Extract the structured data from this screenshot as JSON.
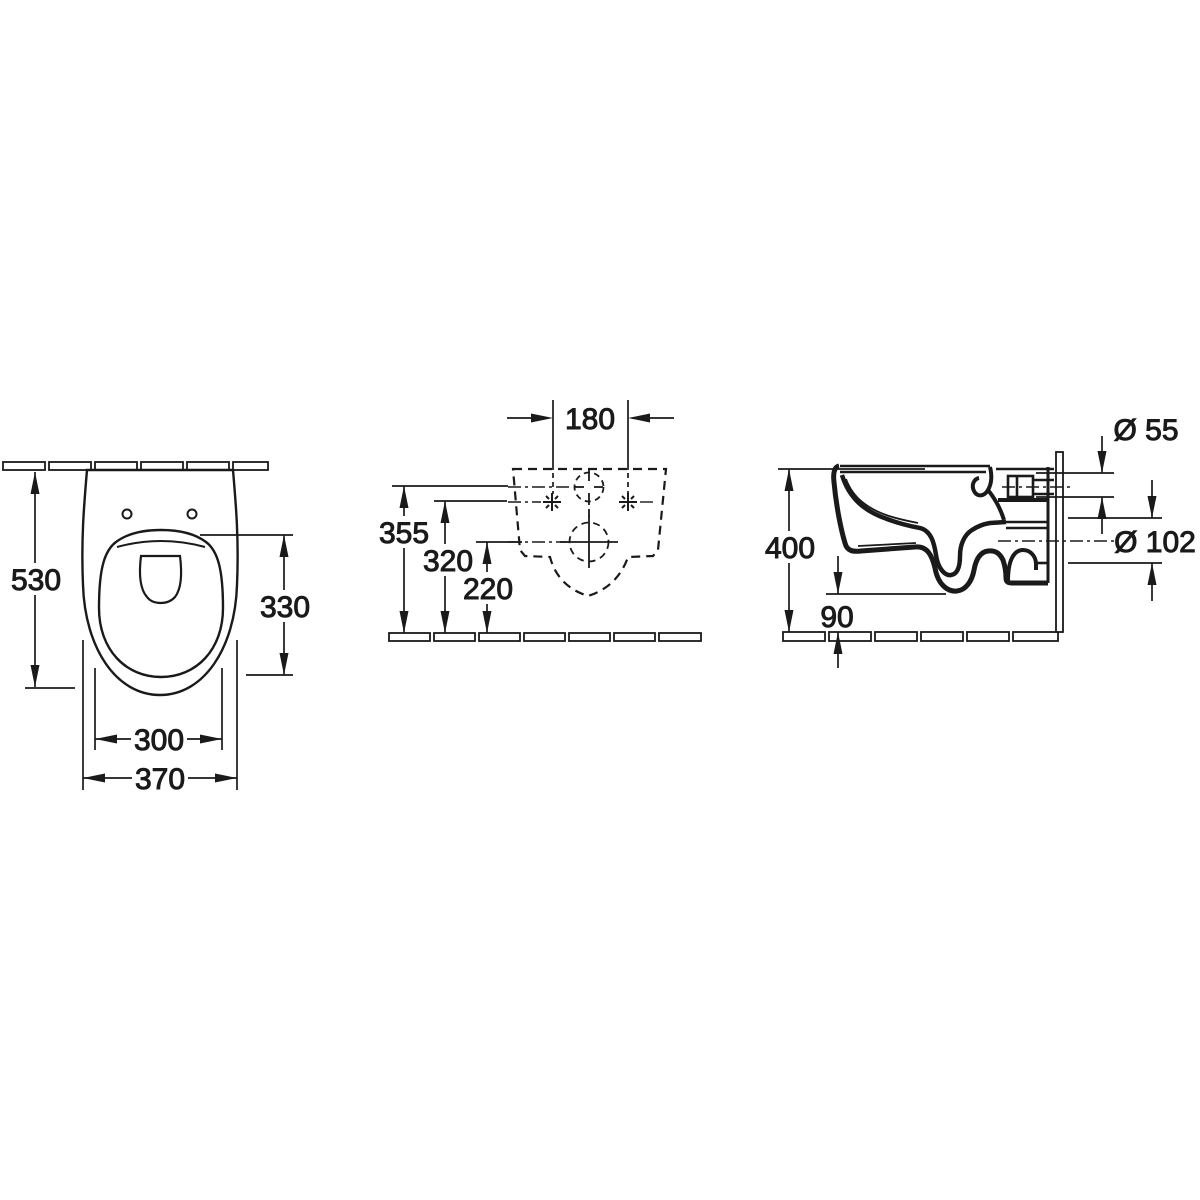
{
  "drawing": {
    "type": "wall-hung-toilet-dimension-drawing",
    "top_view": {
      "depth": "530",
      "seat_opening_length": "330",
      "bowl_inner_width": "300",
      "overall_width": "370"
    },
    "wall_view": {
      "bolt_spacing": "180",
      "inlet_height": "355",
      "fixing_hole_height": "320",
      "outlet_height": "220"
    },
    "side_view": {
      "rim_height": "400",
      "bottom_clearance": "90",
      "inlet_diameter": "Ø 55",
      "outlet_diameter": "Ø 102"
    },
    "colors": {
      "line": "#1a1a1a",
      "background": "#ffffff"
    }
  }
}
